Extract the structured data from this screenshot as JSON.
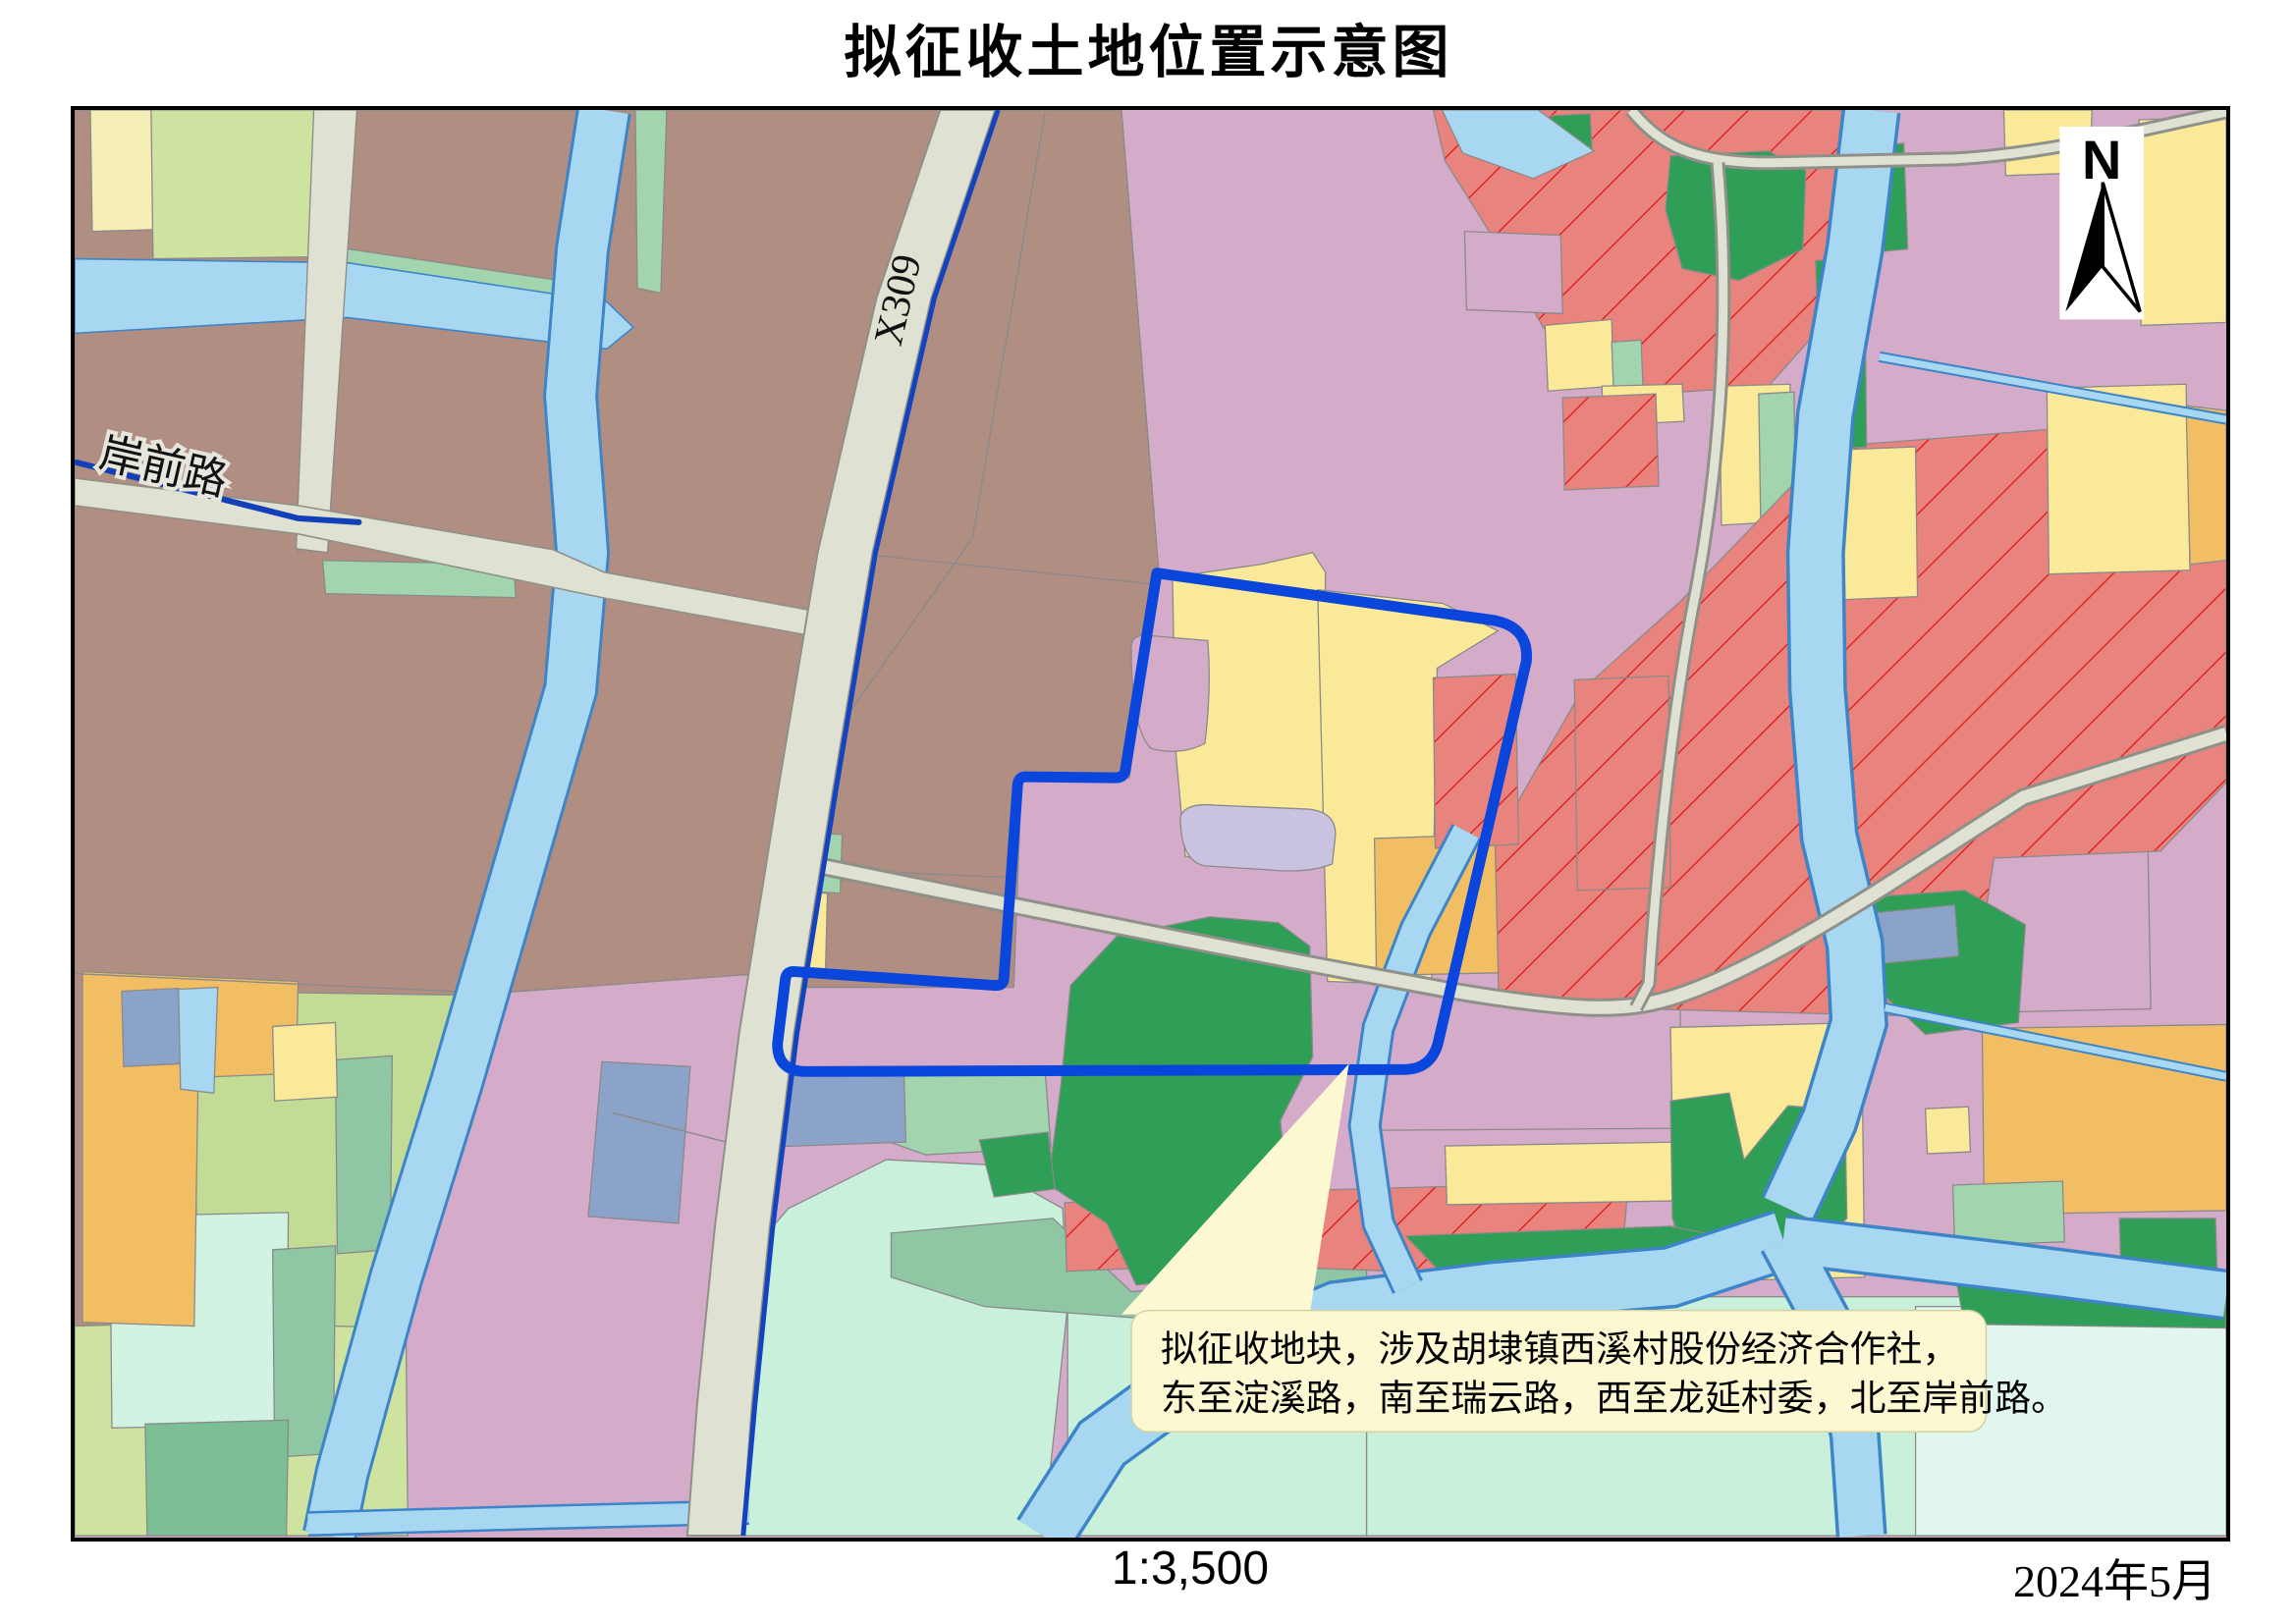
{
  "title": "拟征收土地位置示意图",
  "map": {
    "road_labels": {
      "x309": "X309",
      "anqianlu": "岸前路"
    },
    "north_label": "N",
    "callout": {
      "line1": "拟征收地块，涉及胡埭镇西溪村股份经济合作社，",
      "line2": "东至淀溪路，南至瑞云路，西至龙延村委，北至岸前路。"
    }
  },
  "footer": {
    "scale": "1:3,500",
    "date": "2024年5月"
  },
  "colors": {
    "boundary_blue": "#0a46dc",
    "road_edge_blue": "#1443c0",
    "stream_label_blue": "#1240b8",
    "callout_bg": "#fcf9d2",
    "pink_base": "#d5abca",
    "brown": "#b18e82",
    "yellow": "#fae998",
    "orange": "#f2be63",
    "green": "#2f9e57",
    "mint": "#a2d4ad",
    "mint_light": "#c9f0da",
    "lavender": "#c9c2e0",
    "slate": "#8ba3c9",
    "red_hatch_fill": "#e8837d",
    "red_hatch_line": "#e01818",
    "water": "#a8d7f2",
    "road_fill": "#dfe2d2"
  }
}
